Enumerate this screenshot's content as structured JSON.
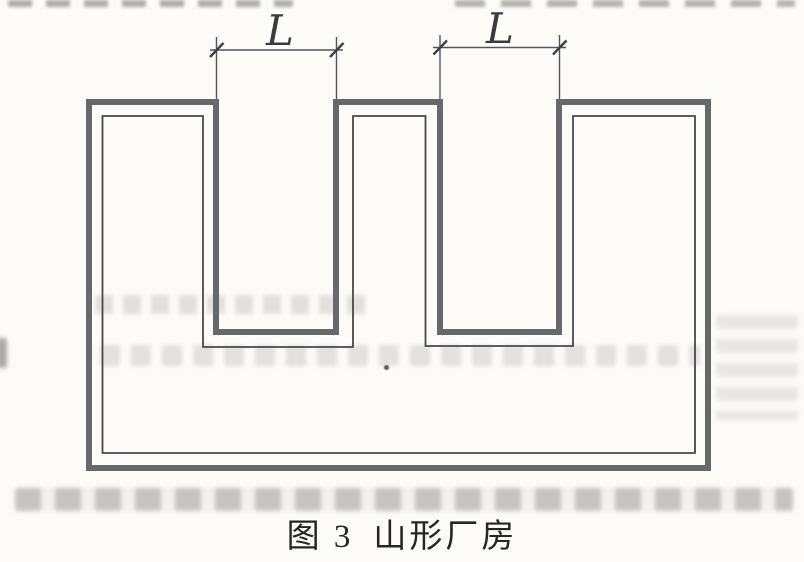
{
  "figure": {
    "number_label": "图 3",
    "title": "山形厂房",
    "caption_full": "图 3 山形厂房",
    "dimension_labels": [
      "L",
      "L"
    ]
  },
  "colors": {
    "paper": "#fcfbf7",
    "wall_outline_thick": "#67686b",
    "wall_outline_thin": "#47484c",
    "dimension_line": "#55565a",
    "caption_text": "#262626"
  }
}
